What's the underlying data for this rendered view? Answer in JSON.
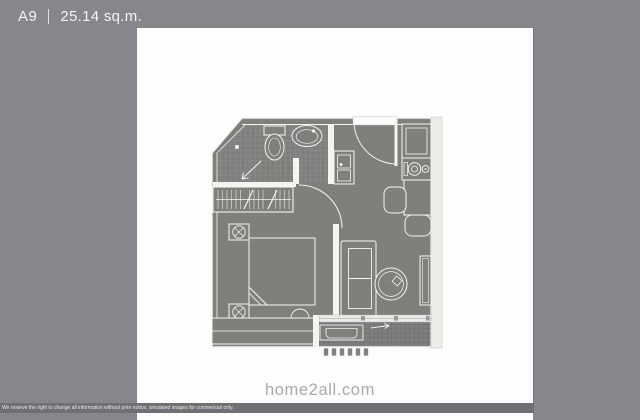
{
  "header": {
    "unit_label": "A9",
    "separator": "|",
    "area": "25.14 sq.m."
  },
  "watermark": "home2all.com",
  "disclaimer": "We reserve the right to change all information without prior notice, simulated images for commercial only.",
  "colors": {
    "page_bg": "#87878b",
    "canvas_bg": "#fdfdfd",
    "plan_fill": "#7f7f7c",
    "wall_line": "#f4f4f1",
    "tile_line": "#a4a4a0",
    "balcony_grid_line": "#686866",
    "disclaimer_bg": "#707074",
    "watermark_color": "#a9a9a7"
  },
  "floorplan": {
    "unit": "A9",
    "area_sqm": 25.14,
    "rooms": [
      "bathroom",
      "wardrobe",
      "entry-hall",
      "kitchen",
      "bedroom",
      "living-room",
      "balcony"
    ],
    "fixtures": [
      "toilet",
      "wash-basin",
      "shower-drain-arrow",
      "wardrobe-hanging-rail",
      "entry-door-swing",
      "utility-sink-unit",
      "refrigerator-cabinet",
      "two-burner-stove",
      "dining-table",
      "dining-chairs",
      "bed-with-folded-blanket",
      "nightstand-lamps",
      "bedroom-window",
      "sofa",
      "round-side-table",
      "tv-console",
      "sliding-door-track",
      "ac-condenser-unit",
      "balcony-drain-arrow",
      "balcony-louvers"
    ]
  }
}
